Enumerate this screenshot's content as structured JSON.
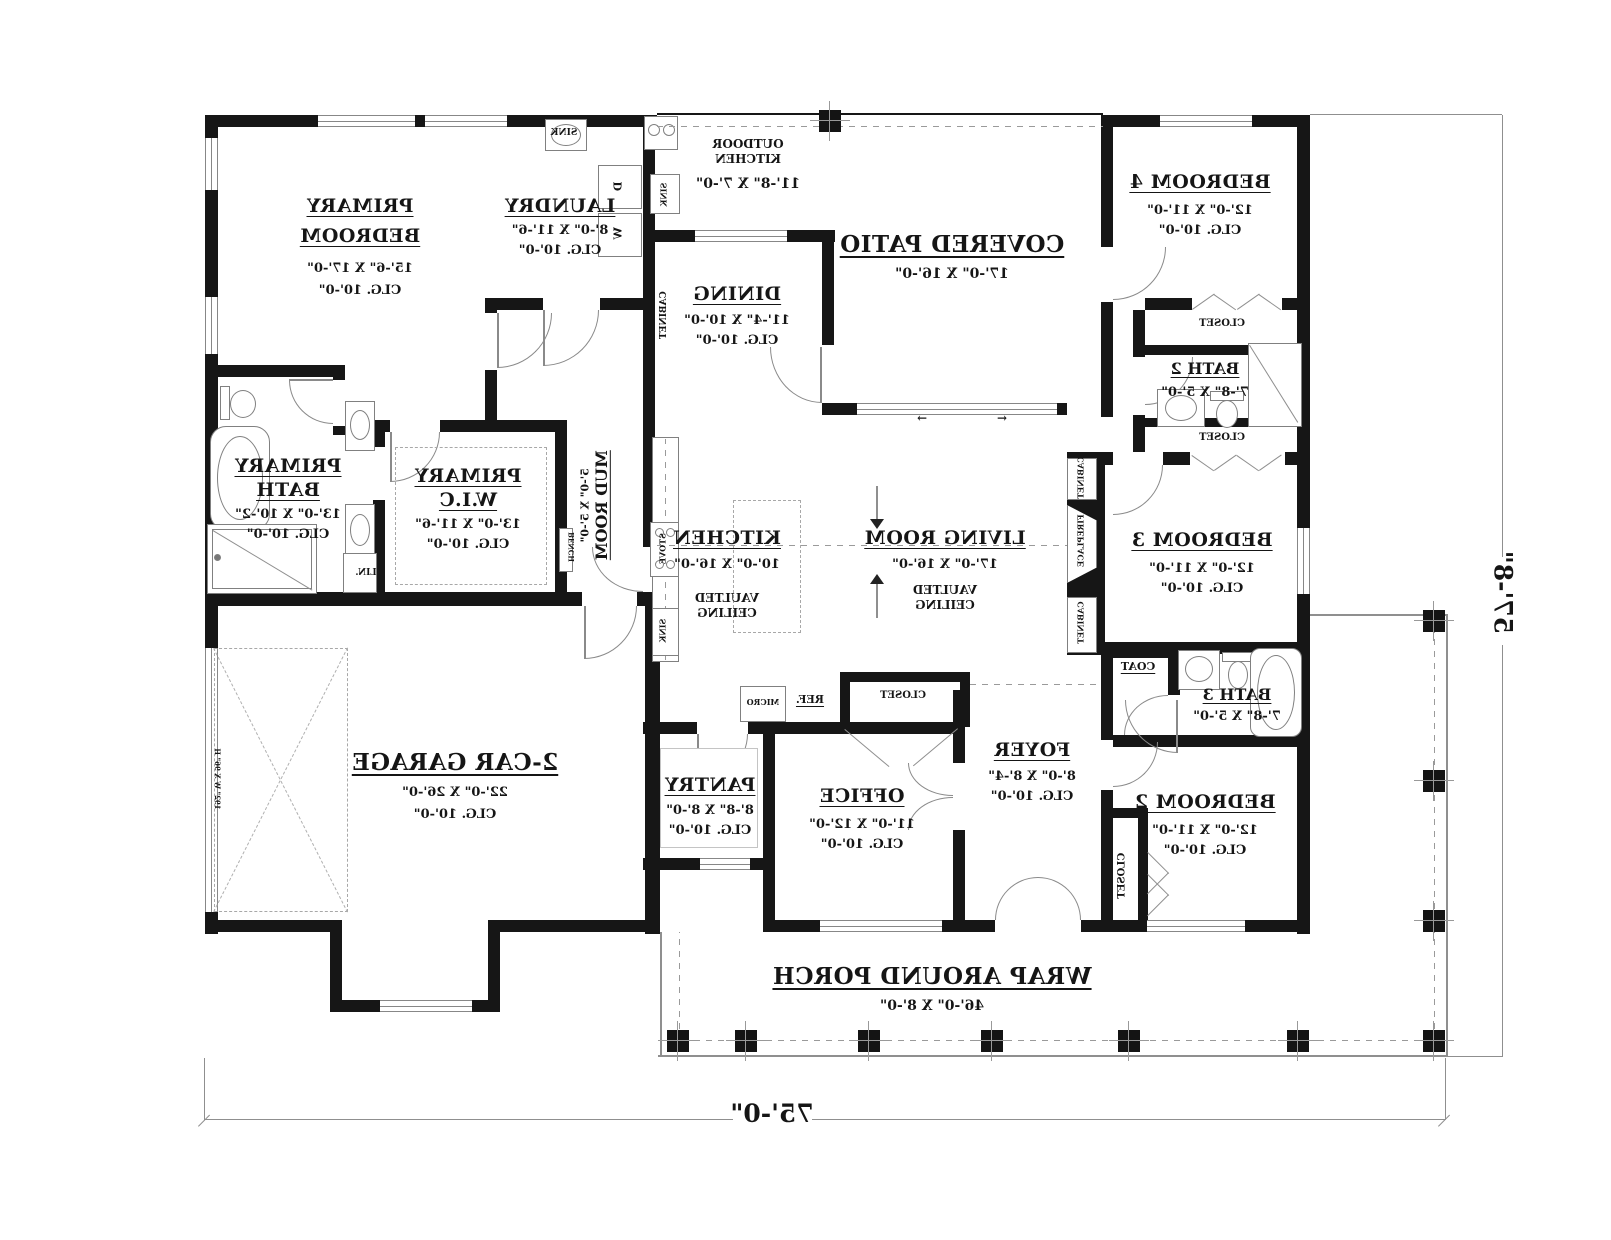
{
  "plan": {
    "rooms": {
      "primary_bedroom": {
        "name1": "PRIMARY",
        "name2": "BEDROOM",
        "dims": "15'-6\" X 17'-0\"",
        "clg": "CLG. 10'-0\""
      },
      "laundry": {
        "name": "LAUNDRY",
        "dims": "8'-0\" X 11'-6\"",
        "clg": "CLG. 10'-0\""
      },
      "outdoor_kitchen": {
        "name1": "OUTDOOR",
        "name2": "KITCHEN",
        "dims": "11'-8\" X 7'-0\""
      },
      "covered_patio": {
        "name": "COVERED PATIO",
        "dims": "17'-0\" X 16'-0\""
      },
      "dining": {
        "name": "DINING",
        "dims": "11'-4\" X 10'-0\"",
        "clg": "CLG. 10'-0\""
      },
      "bedroom4": {
        "name": "BEDROOM 4",
        "dims": "12'-0\" X 11'-0\"",
        "clg": "CLG. 10'-0\""
      },
      "bath2": {
        "name": "BATH 2",
        "dims": "7'-8\" X 5'-0\""
      },
      "bedroom3": {
        "name": "BEDROOM 3",
        "dims": "12'-0\" X 11'-0\"",
        "clg": "CLG. 10'-0\""
      },
      "primary_bath": {
        "name1": "PRIMARY",
        "name2": "BATH",
        "dims": "13'-0\" X 10'-2\"",
        "clg": "CLG. 10'-0\""
      },
      "primary_wic": {
        "name1": "PRIMARY",
        "name2": "W.I.C",
        "dims": "13'-0\" X 11'-6\"",
        "clg": "CLG. 10'-0\""
      },
      "mud_room": {
        "name": "MUD ROOM",
        "dims": "5'-0\" X 5'-0\""
      },
      "kitchen": {
        "name": "KITCHEN",
        "dims": "10'-0\" X 16'-0\"",
        "note1": "VAULTED",
        "note2": "CEILING"
      },
      "living_room": {
        "name": "LIVING ROOM",
        "dims": "17'-0\" X 16'-0\"",
        "note1": "VAULTED",
        "note2": "CEILING"
      },
      "garage": {
        "name": "2-CAR GARAGE",
        "dims": "22'-0\" X 26'-0\"",
        "clg": "CLG. 10'-0\""
      },
      "pantry": {
        "name": "PANTRY",
        "dims": "8'-8\" X 8'-0\"",
        "clg": "CLG. 10'-0\""
      },
      "office": {
        "name": "OFFICE",
        "dims": "11'-0\" X 12'-0\"",
        "clg": "CLG. 10'-0\""
      },
      "foyer": {
        "name": "FOYER",
        "dims": "8'-0\" X 8'-4\"",
        "clg": "CLG. 10'-0\""
      },
      "bedroom2": {
        "name": "BEDROOM 2",
        "dims": "12'-0\" X 11'-0\"",
        "clg": "CLG. 10'-0\""
      },
      "bath3": {
        "name": "BATH 3",
        "dims": "7'-8\" X 5'-0\""
      },
      "porch": {
        "name": "WRAP AROUND PORCH",
        "dims": "46'-0\" X 8'-0\""
      }
    },
    "labels": {
      "closet": "CLOSET",
      "coat": "COAT",
      "cabinet": "CABINET",
      "fireplace": "FIREPLACE",
      "bench": "BENCH",
      "linen": "LIN.",
      "sink": "SINK",
      "stove": "STOVE",
      "micro": "MICRO",
      "fridge": "REF.",
      "washer": "W",
      "dryer": "D",
      "garage_door": "192\" W X 96\" H",
      "slide_left": "←",
      "slide_right": "→"
    },
    "dimensions": {
      "overall_width": "75'-0\"",
      "overall_depth": "57'-8\""
    }
  }
}
